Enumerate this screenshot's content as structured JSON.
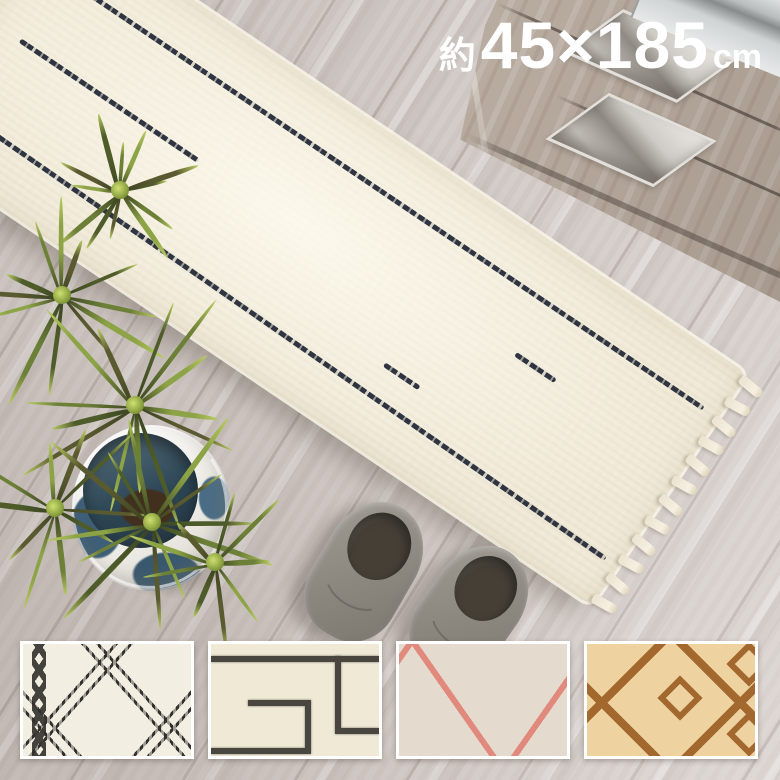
{
  "size_label": {
    "approx_prefix": "約",
    "dimensions": "45×185",
    "unit": "cm",
    "text_color": "#ffffff"
  },
  "variants": [
    {
      "name": "ivory-black-diamond",
      "base": "#f2eee1",
      "line": "#32302c"
    },
    {
      "name": "ivory-charcoal-line",
      "base": "#efe9d5",
      "line": "#48463f"
    },
    {
      "name": "greige-pink-diamond",
      "base": "#e4dacd",
      "line": "#e0897c"
    },
    {
      "name": "sand-brown-diamond",
      "base": "#eed3a0",
      "line": "#a2682e"
    }
  ],
  "scene": {
    "floor": "#d5cdc9",
    "rug": {
      "base": "#f0e9d7",
      "line": "#2e3440",
      "tassel": "#ece3d0"
    },
    "plant": {
      "leaves": [
        "#4e5c2a",
        "#6d8038",
        "#8da446",
        "#5a5a30"
      ],
      "highlight": "#b9cb62",
      "pot": "#f3f1ec",
      "pot_accent": "#3e5f78",
      "soil": "#42301e"
    },
    "slippers": {
      "base": "#8f8b83",
      "opening": "#453f36"
    },
    "cabinet": {
      "panel": "#b7aa9e",
      "metal": "#d8d7d5"
    }
  }
}
